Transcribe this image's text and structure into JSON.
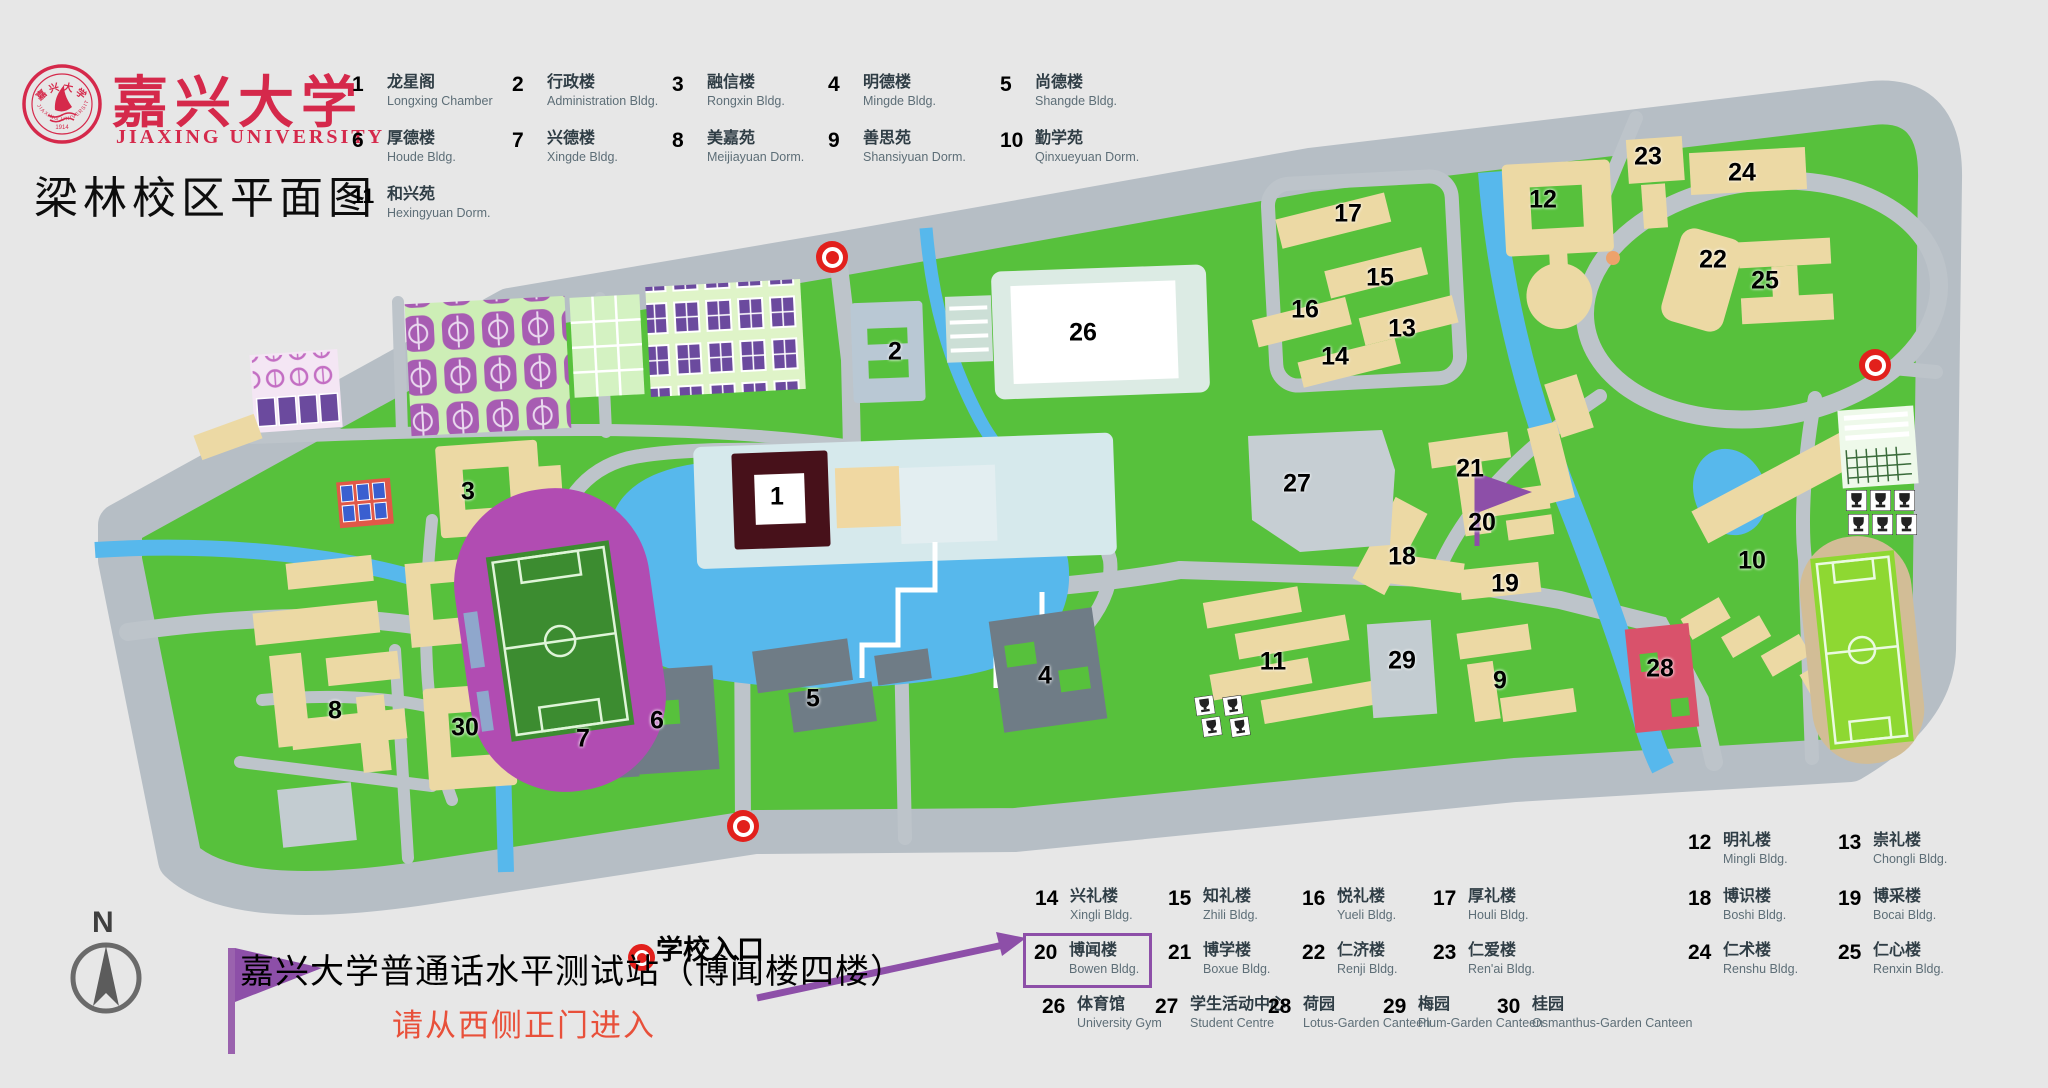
{
  "header": {
    "university_cn": "嘉兴大学",
    "university_en": "JIAXING UNIVERSITY",
    "seal_bottom_text": "JIAXING UNIVERSITY",
    "seal_year": "1914",
    "title": "梁林校区平面图"
  },
  "legend_top": {
    "items": [
      {
        "num": "1",
        "cn": "龙星阁",
        "en": "Longxing Chamber",
        "col": 0,
        "row": 0
      },
      {
        "num": "2",
        "cn": "行政楼",
        "en": "Administration Bldg.",
        "col": 1,
        "row": 0
      },
      {
        "num": "3",
        "cn": "融信楼",
        "en": "Rongxin Bldg.",
        "col": 2,
        "row": 0
      },
      {
        "num": "4",
        "cn": "明德楼",
        "en": "Mingde Bldg.",
        "col": 3,
        "row": 0
      },
      {
        "num": "5",
        "cn": "尚德楼",
        "en": "Shangde Bldg.",
        "col": 4,
        "row": 0
      },
      {
        "num": "6",
        "cn": "厚德楼",
        "en": "Houde Bldg.",
        "col": 0,
        "row": 1
      },
      {
        "num": "7",
        "cn": "兴德楼",
        "en": "Xingde Bldg.",
        "col": 1,
        "row": 1
      },
      {
        "num": "8",
        "cn": "美嘉苑",
        "en": "Meijiayuan Dorm.",
        "col": 2,
        "row": 1
      },
      {
        "num": "9",
        "cn": "善思苑",
        "en": "Shansiyuan Dorm.",
        "col": 3,
        "row": 1
      },
      {
        "num": "10",
        "cn": "勤学苑",
        "en": "Qinxueyuan Dorm.",
        "col": 4,
        "row": 1
      },
      {
        "num": "11",
        "cn": "和兴苑",
        "en": "Hexingyuan Dorm.",
        "col": 0,
        "row": 2
      }
    ]
  },
  "legend_bottom": {
    "items": [
      {
        "num": "12",
        "cn": "明礼楼",
        "en": "Mingli Bldg.",
        "x": 1688,
        "y": 832
      },
      {
        "num": "13",
        "cn": "崇礼楼",
        "en": "Chongli Bldg.",
        "x": 1838,
        "y": 832
      },
      {
        "num": "14",
        "cn": "兴礼楼",
        "en": "Xingli Bldg.",
        "x": 1035,
        "y": 888
      },
      {
        "num": "15",
        "cn": "知礼楼",
        "en": "Zhili Bldg.",
        "x": 1168,
        "y": 888
      },
      {
        "num": "16",
        "cn": "悦礼楼",
        "en": "Yueli Bldg.",
        "x": 1302,
        "y": 888
      },
      {
        "num": "17",
        "cn": "厚礼楼",
        "en": "Houli Bldg.",
        "x": 1433,
        "y": 888
      },
      {
        "num": "18",
        "cn": "博识楼",
        "en": "Boshi Bldg.",
        "x": 1688,
        "y": 888
      },
      {
        "num": "19",
        "cn": "博采楼",
        "en": "Bocai Bldg.",
        "x": 1838,
        "y": 888
      },
      {
        "num": "20",
        "cn": "博闻楼",
        "en": "Bowen Bldg.",
        "x": 1035,
        "y": 942,
        "boxed": true
      },
      {
        "num": "21",
        "cn": "博学楼",
        "en": "Boxue Bldg.",
        "x": 1168,
        "y": 942
      },
      {
        "num": "22",
        "cn": "仁济楼",
        "en": "Renji Bldg.",
        "x": 1302,
        "y": 942
      },
      {
        "num": "23",
        "cn": "仁爱楼",
        "en": "Ren'ai Bldg.",
        "x": 1433,
        "y": 942
      },
      {
        "num": "24",
        "cn": "仁术楼",
        "en": "Renshu Bldg.",
        "x": 1688,
        "y": 942
      },
      {
        "num": "25",
        "cn": "仁心楼",
        "en": "Renxin Bldg.",
        "x": 1838,
        "y": 942
      },
      {
        "num": "26",
        "cn": "体育馆",
        "en": "University Gym",
        "x": 1042,
        "y": 996
      },
      {
        "num": "27",
        "cn": "学生活动中心",
        "en": "Student Centre",
        "x": 1155,
        "y": 996
      },
      {
        "num": "28",
        "cn": "荷园",
        "en": "Lotus-Garden Canteen",
        "x": 1268,
        "y": 996
      },
      {
        "num": "29",
        "cn": "梅园",
        "en": "Plum-Garden Canteen",
        "x": 1383,
        "y": 996
      },
      {
        "num": "30",
        "cn": "桂园",
        "en": "Osmanthus-Garden Canteen",
        "x": 1497,
        "y": 996
      }
    ]
  },
  "entrance_legend": {
    "label": "学校入口"
  },
  "annotation": {
    "text_main": "嘉兴大学普通话水平测试站（博闻楼四楼）",
    "text_sub": "请从西侧正门进入"
  },
  "compass": {
    "label": "N"
  },
  "map": {
    "numbers": [
      {
        "n": "1",
        "x": 777,
        "y": 497,
        "on_white": true
      },
      {
        "n": "2",
        "x": 895,
        "y": 352
      },
      {
        "n": "3",
        "x": 468,
        "y": 492
      },
      {
        "n": "4",
        "x": 1045,
        "y": 676
      },
      {
        "n": "5",
        "x": 813,
        "y": 699
      },
      {
        "n": "6",
        "x": 657,
        "y": 721
      },
      {
        "n": "7",
        "x": 583,
        "y": 739
      },
      {
        "n": "8",
        "x": 335,
        "y": 711
      },
      {
        "n": "9",
        "x": 1500,
        "y": 681
      },
      {
        "n": "10",
        "x": 1752,
        "y": 561
      },
      {
        "n": "11",
        "x": 1273,
        "y": 662
      },
      {
        "n": "12",
        "x": 1543,
        "y": 200
      },
      {
        "n": "13",
        "x": 1402,
        "y": 329
      },
      {
        "n": "14",
        "x": 1335,
        "y": 357
      },
      {
        "n": "15",
        "x": 1380,
        "y": 278
      },
      {
        "n": "16",
        "x": 1305,
        "y": 310
      },
      {
        "n": "17",
        "x": 1348,
        "y": 214
      },
      {
        "n": "18",
        "x": 1402,
        "y": 557
      },
      {
        "n": "19",
        "x": 1505,
        "y": 584
      },
      {
        "n": "20",
        "x": 1482,
        "y": 523
      },
      {
        "n": "21",
        "x": 1470,
        "y": 469
      },
      {
        "n": "22",
        "x": 1713,
        "y": 260
      },
      {
        "n": "23",
        "x": 1648,
        "y": 157
      },
      {
        "n": "24",
        "x": 1742,
        "y": 173
      },
      {
        "n": "25",
        "x": 1765,
        "y": 281
      },
      {
        "n": "26",
        "x": 1083,
        "y": 333
      },
      {
        "n": "27",
        "x": 1297,
        "y": 484
      },
      {
        "n": "28",
        "x": 1660,
        "y": 669
      },
      {
        "n": "29",
        "x": 1402,
        "y": 661
      },
      {
        "n": "30",
        "x": 465,
        "y": 728
      }
    ],
    "entrances": [
      {
        "x": 832,
        "y": 257
      },
      {
        "x": 743,
        "y": 826
      },
      {
        "x": 1875,
        "y": 365
      }
    ],
    "flag": {
      "x": 1477,
      "y": 475
    }
  },
  "colors": {
    "brand_red": "#d5294b",
    "purple": "#8d4fa8",
    "road": "#b9c1c8",
    "green": "#57c13c",
    "water": "#57b8ec",
    "tan": "#ecd9a4",
    "dark_bldg": "#6f7c86",
    "marker_red": "#e2201c",
    "note_red": "#e8503a"
  }
}
